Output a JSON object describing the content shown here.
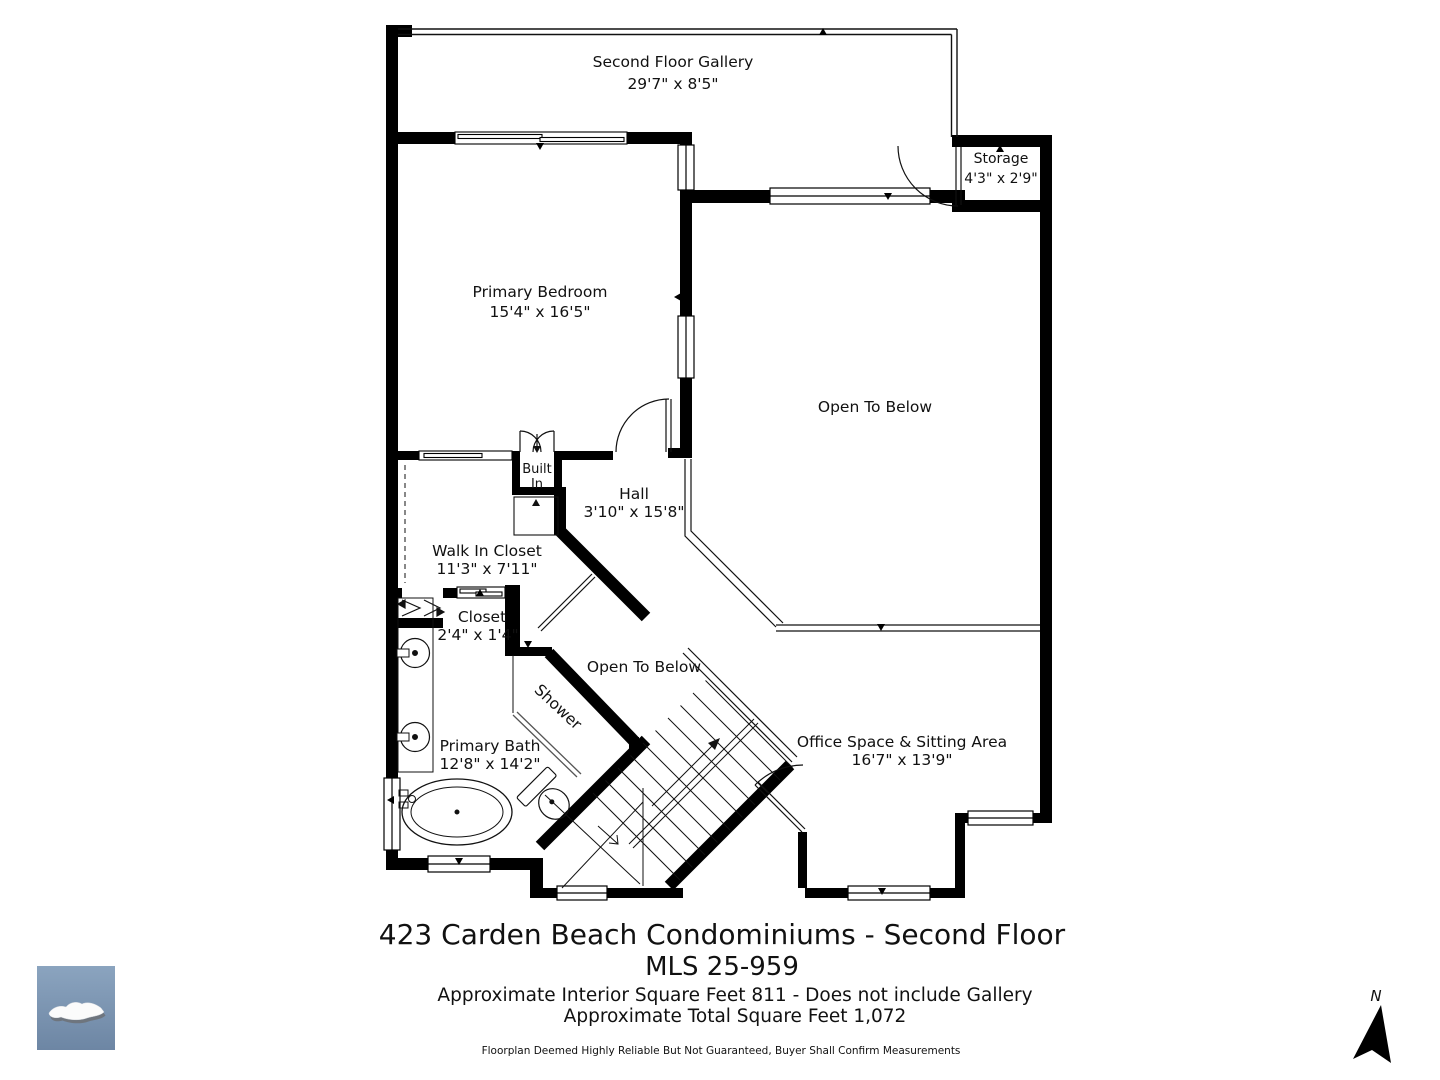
{
  "rooms": {
    "gallery": {
      "name": "Second Floor Gallery",
      "dims": "29'7\" x 8'5\""
    },
    "storage": {
      "name": "Storage",
      "dims": "4'3\" x 2'9\""
    },
    "primary_bedroom": {
      "name": "Primary Bedroom",
      "dims": "15'4\" x 16'5\""
    },
    "open_to_below_right": {
      "name": "Open To Below"
    },
    "built_in": {
      "line1": "Built",
      "line2": "In"
    },
    "hall": {
      "name": "Hall",
      "dims": "3'10\" x 15'8\""
    },
    "walk_in_closet": {
      "name": "Walk In Closet",
      "dims": "11'3\" x 7'11\""
    },
    "closet": {
      "name": "Closet",
      "dims": "2'4\" x 1'4\""
    },
    "open_to_below_center": {
      "name": "Open To Below"
    },
    "shower": {
      "name": "Shower"
    },
    "primary_bath": {
      "name": "Primary Bath",
      "dims": "12'8\" x 14'2\""
    },
    "office": {
      "name": "Office Space & Sitting Area",
      "dims": "16'7\" x 13'9\""
    }
  },
  "title_block": {
    "line1": "423 Carden Beach Condominiums - Second Floor",
    "line2": "MLS 25-959",
    "line3": "Approximate Interior Square Feet 811 - Does not include Gallery",
    "line4": "Approximate Total Square Feet 1,072",
    "disclaimer": "Floorplan Deemed Highly Reliable But Not Guaranteed, Buyer Shall Confirm Measurements"
  },
  "compass": {
    "label": "N"
  },
  "colors": {
    "wall": "#000000",
    "line": "#111111",
    "logo_top": "#8ba4bf",
    "logo_bottom": "#6d86a4"
  }
}
